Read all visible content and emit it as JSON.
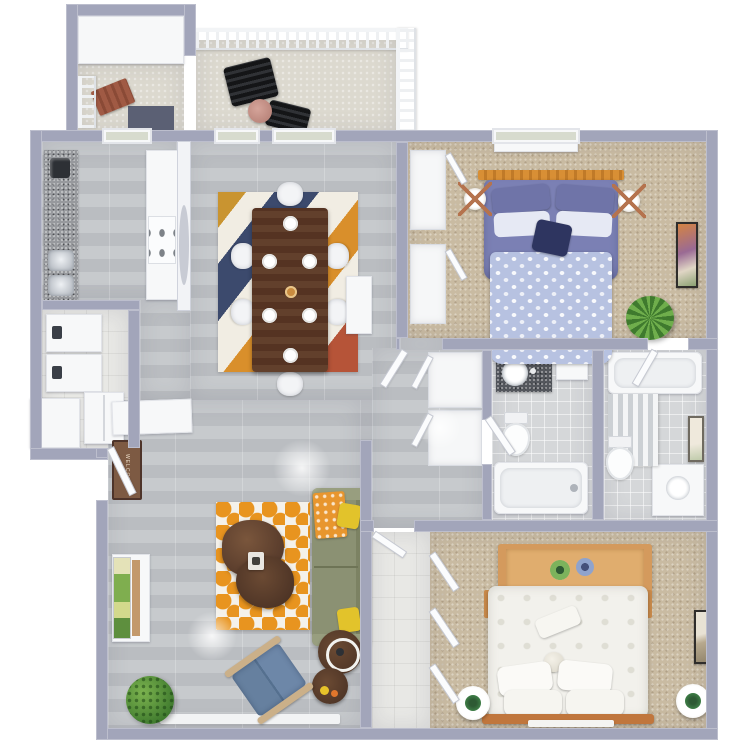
{
  "meta": {
    "description": "Top-down 3D rendered floor plan of a two bedroom, two bathroom apartment with balcony",
    "view": "top-down 3d render",
    "canvas": {
      "width": 750,
      "height": 750
    },
    "background": "#ffffff"
  },
  "palette": {
    "walls": "#a2a5ba",
    "wall_faces": "#f2f3f6",
    "wood_floor": "#bfc2c5",
    "carpet": "#c9bba2",
    "bath_tile": "#d5d7d9",
    "laundry_tile": "#e8e8e5",
    "balcony_concrete": "#dcd9cf",
    "sofa_green": "#8b9173",
    "accent_orange": "#e8941f",
    "bed1_duvet": "#7b80b4",
    "bed1_blanket": "#b7c2e1",
    "dining_table_wood": "#5d3a28",
    "dresser_tan": "#d49a5d",
    "rug_navy": "#3c4a6d",
    "rug_rust": "#b65438",
    "chair_blue": "#6d87a8",
    "pillow_yellow": "#e2c32b",
    "plant_green": "#3f7a2e"
  },
  "entry": {
    "mat_text": "WELCOME"
  },
  "rooms": [
    {
      "id": "balcony",
      "name": "Balcony",
      "floor": "concrete",
      "furniture": [
        "rocking chair",
        "rocking chair",
        "round side table",
        "white railing"
      ]
    },
    {
      "id": "entry-stair",
      "name": "Entry Stairwell",
      "floor": "concrete",
      "furniture": [
        "bench",
        "railing"
      ]
    },
    {
      "id": "kitchen",
      "name": "Kitchen",
      "floor": "wood",
      "furniture": [
        "granite counter",
        "double sink",
        "coffee maker",
        "stove",
        "cabinets"
      ]
    },
    {
      "id": "laundry",
      "name": "Laundry Closet",
      "floor": "tile",
      "furniture": [
        "washer",
        "dryer",
        "refrigerator"
      ]
    },
    {
      "id": "dining",
      "name": "Dining Room",
      "floor": "wood",
      "furniture": [
        "wood dining table",
        "six white chairs",
        "striped area rug",
        "place settings",
        "white console"
      ]
    },
    {
      "id": "living",
      "name": "Living Room",
      "floor": "wood",
      "furniture": [
        "green sofa",
        "orange patterned rug",
        "organic coffee table",
        "blue accent chair",
        "nesting side tables",
        "media console with art",
        "potted plant",
        "welcome mat"
      ]
    },
    {
      "id": "bedroom-1",
      "name": "Bedroom 1",
      "floor": "carpet",
      "furniture": [
        "bed with purple bedding",
        "two lamps on stands",
        "closets",
        "low dresser",
        "wall art",
        "floor plant"
      ]
    },
    {
      "id": "bathroom-1",
      "name": "Bathroom 1",
      "floor": "tile",
      "furniture": [
        "granite vanity with round sink",
        "toilet",
        "bathtub"
      ]
    },
    {
      "id": "bathroom-2",
      "name": "Bathroom 2",
      "floor": "tile",
      "furniture": [
        "bathtub",
        "striped shower curtain",
        "toilet",
        "white vanity",
        "wall art"
      ]
    },
    {
      "id": "hallway",
      "name": "Hallway",
      "floor": "wood",
      "furniture": [
        "linen closets"
      ]
    },
    {
      "id": "bedroom-2",
      "name": "Bedroom 2",
      "floor": "carpet",
      "furniture": [
        "bed with white bedding",
        "wood desk dresser",
        "two round nightstands",
        "closets",
        "wall art"
      ]
    }
  ]
}
